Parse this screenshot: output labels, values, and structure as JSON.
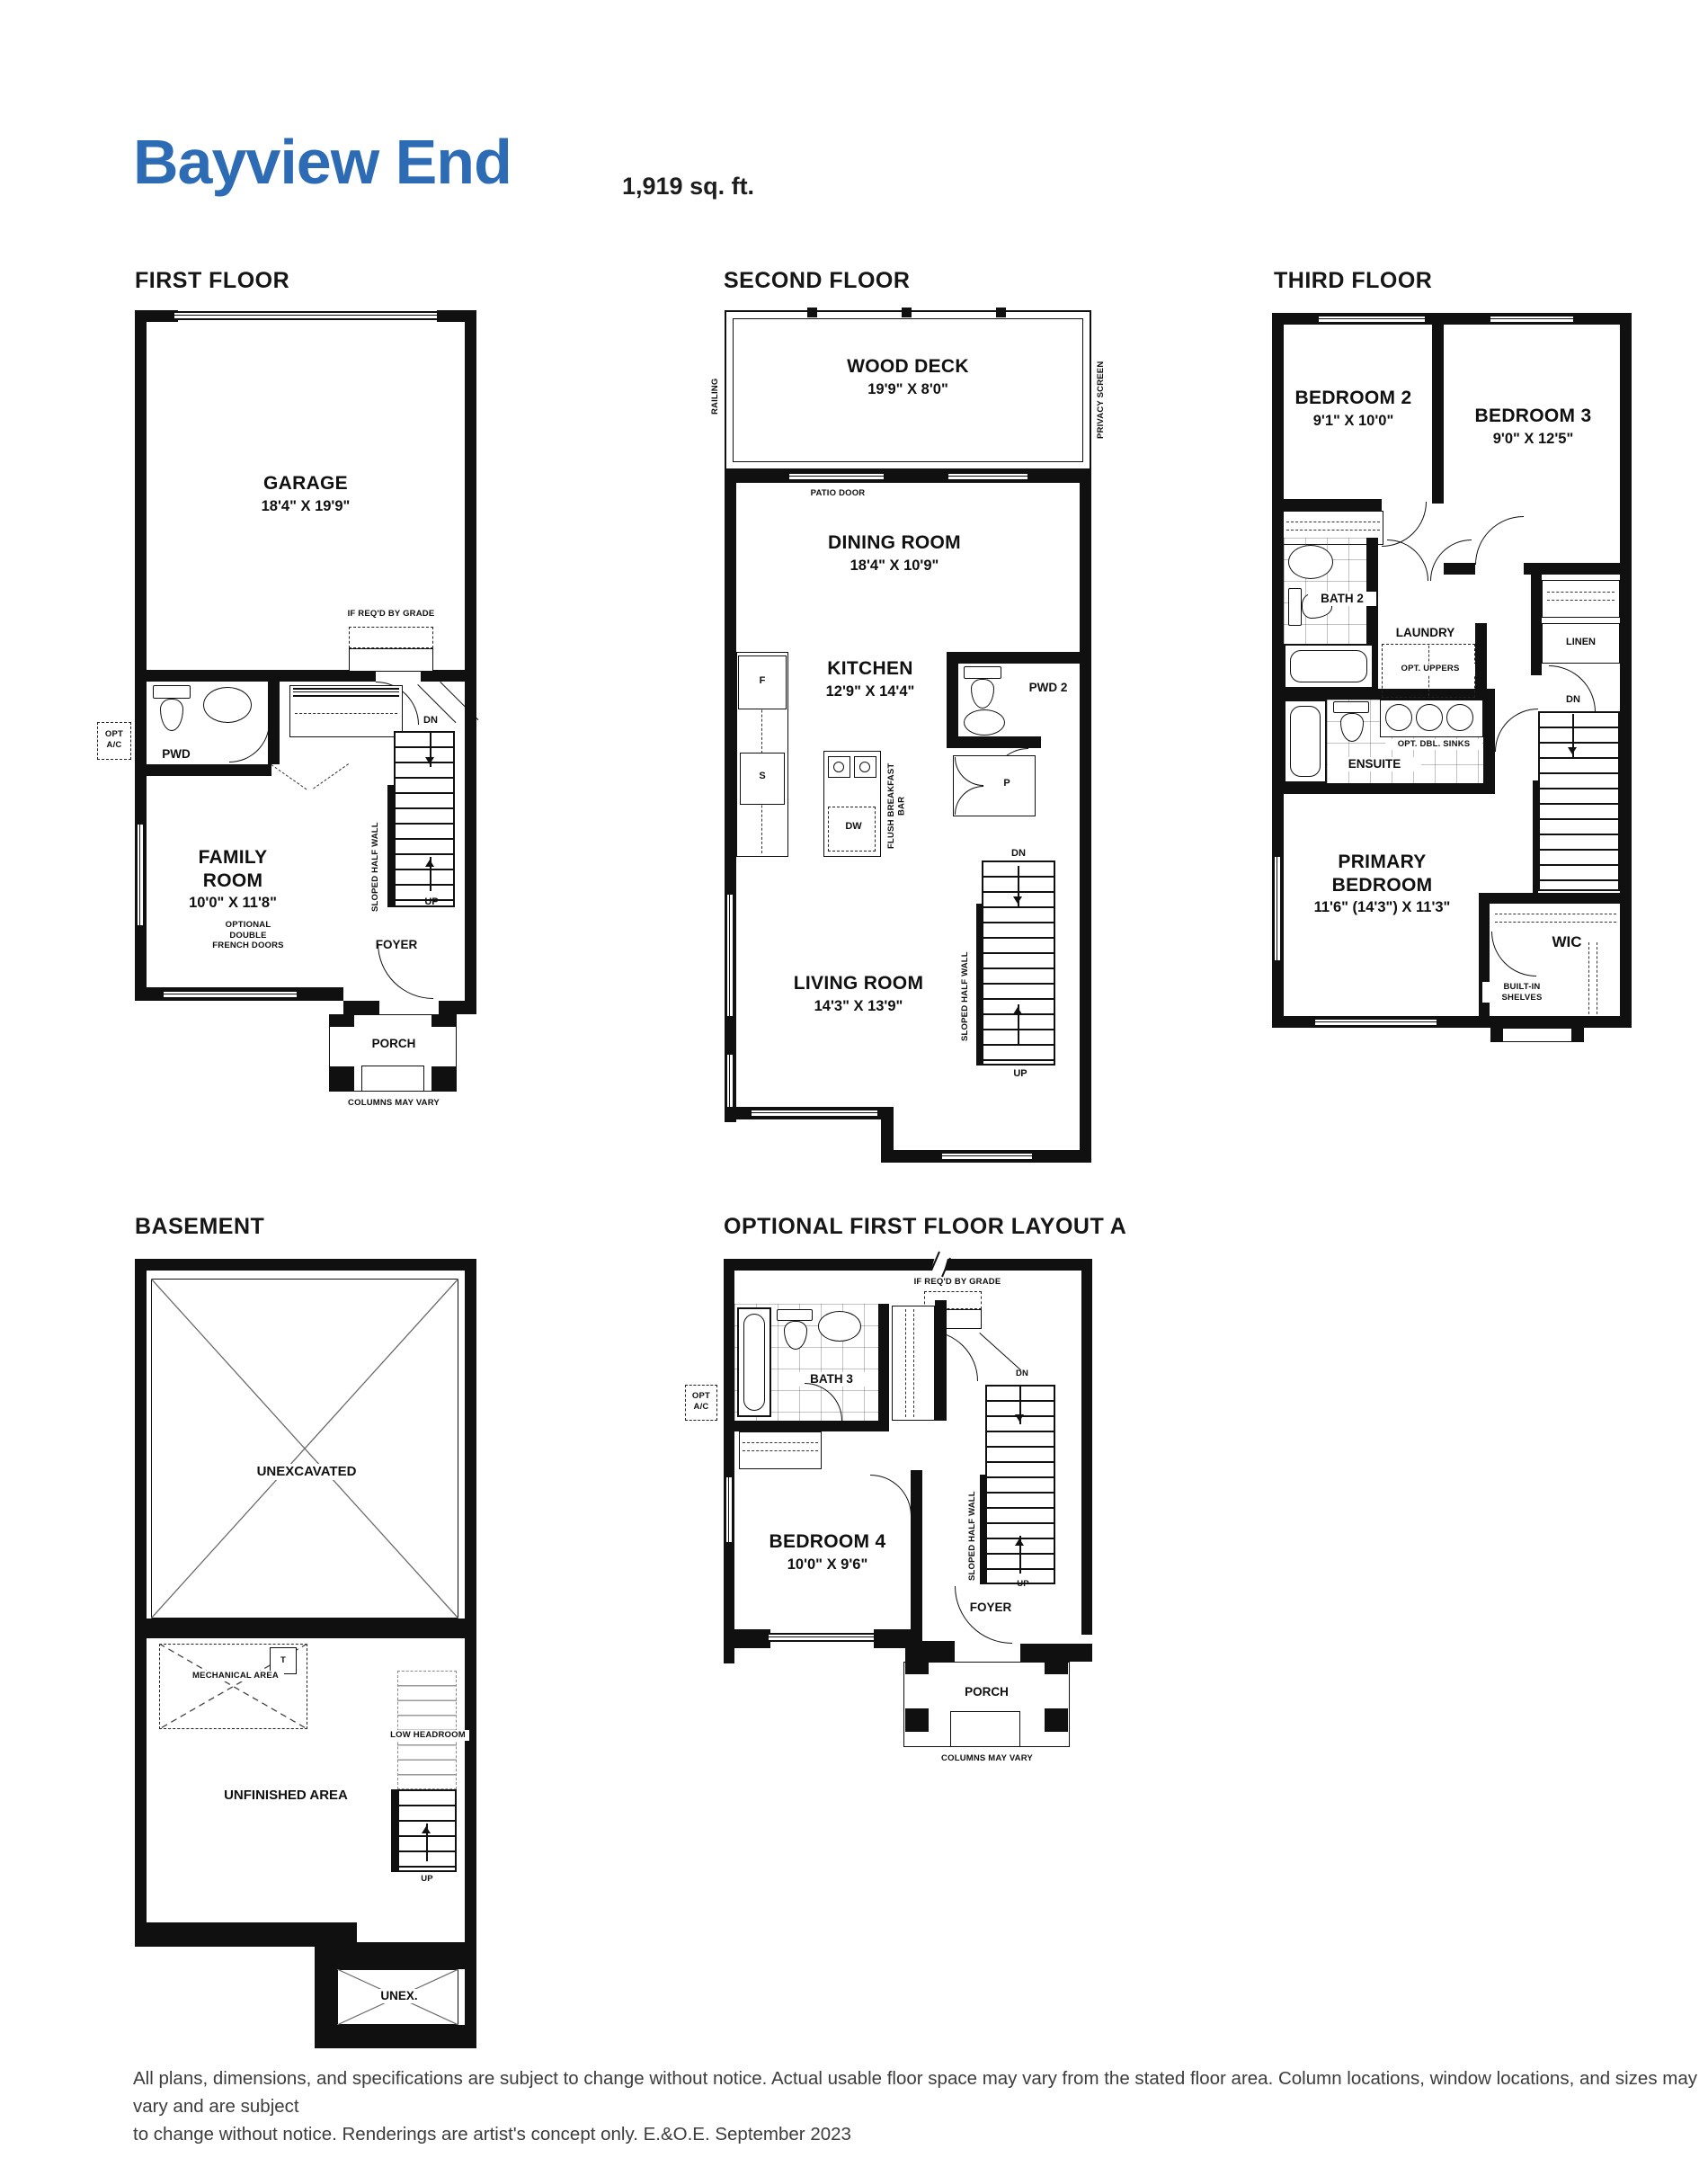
{
  "title": "Bayview End",
  "sqft": "1,919 sq. ft.",
  "accent_color": "#2d6cb4",
  "wall_color": "#101010",
  "footer_line1": "All plans, dimensions, and specifications are subject to change without notice. Actual usable floor space may vary from the stated floor area. Column locations, window locations, and sizes may vary and are subject",
  "footer_line2": "to change without notice. Renderings are artist's concept only. E.&O.E. September 2023",
  "first": {
    "label": "FIRST FLOOR",
    "garage_name": "GARAGE",
    "garage_dims": "18'4\" X 19'9\"",
    "if_reqd": "IF REQ'D BY GRADE",
    "opt_ac": "OPT A/C",
    "pwd": "PWD",
    "family_name": "FAMILY ROOM",
    "family_dims": "10'0\" X 11'8\"",
    "opt_french": "OPTIONAL DOUBLE FRENCH DOORS",
    "sloped": "SLOPED HALF WALL",
    "dn": "DN",
    "up": "UP",
    "foyer": "FOYER",
    "porch": "PORCH",
    "columns": "COLUMNS MAY VARY"
  },
  "second": {
    "label": "SECOND FLOOR",
    "deck_name": "WOOD DECK",
    "deck_dims": "19'9\" X 8'0\"",
    "railing": "RAILING",
    "privacy": "PRIVACY SCREEN",
    "patio": "PATIO DOOR",
    "dining_name": "DINING ROOM",
    "dining_dims": "18'4\" X 10'9\"",
    "kitchen_name": "KITCHEN",
    "kitchen_dims": "12'9\" X 14'4\"",
    "fridge": "F",
    "sink": "S",
    "dw": "DW",
    "flush": "FLUSH BREAKFAST BAR",
    "pwd2": "PWD 2",
    "pantry": "P",
    "living_name": "LIVING ROOM",
    "living_dims": "14'3\" X 13'9\"",
    "sloped": "SLOPED HALF WALL",
    "dn": "DN",
    "up": "UP"
  },
  "third": {
    "label": "THIRD FLOOR",
    "bed2_name": "BEDROOM 2",
    "bed2_dims": "9'1\" X 10'0\"",
    "bed3_name": "BEDROOM 3",
    "bed3_dims": "9'0\" X 12'5\"",
    "bath2": "BATH 2",
    "laundry": "LAUNDRY",
    "opt_uppers": "OPT. UPPERS",
    "linen": "LINEN",
    "ensuite": "ENSUITE",
    "opt_sinks": "OPT. DBL. SINKS",
    "primary_name": "PRIMARY BEDROOM",
    "primary_dims": "11'6\" (14'3\") X 11'3\"",
    "wic": "WIC",
    "builtin": "BUILT-IN SHELVES",
    "dn": "DN"
  },
  "basement": {
    "label": "BASEMENT",
    "unexcavated": "UNEXCAVATED",
    "mech": "MECHANICAL AREA",
    "tank": "T",
    "unfinished": "UNFINISHED AREA",
    "low": "LOW HEADROOM",
    "up": "UP",
    "unex": "UNEX."
  },
  "optional": {
    "label": "OPTIONAL FIRST FLOOR LAYOUT A",
    "if_reqd": "IF REQ'D BY GRADE",
    "bath3": "BATH 3",
    "opt_ac": "OPT A/C",
    "bed4_name": "BEDROOM 4",
    "bed4_dims": "10'0\" X 9'6\"",
    "sloped": "SLOPED HALF WALL",
    "dn": "DN",
    "up": "UP",
    "foyer": "FOYER",
    "porch": "PORCH",
    "columns": "COLUMNS MAY VARY"
  }
}
